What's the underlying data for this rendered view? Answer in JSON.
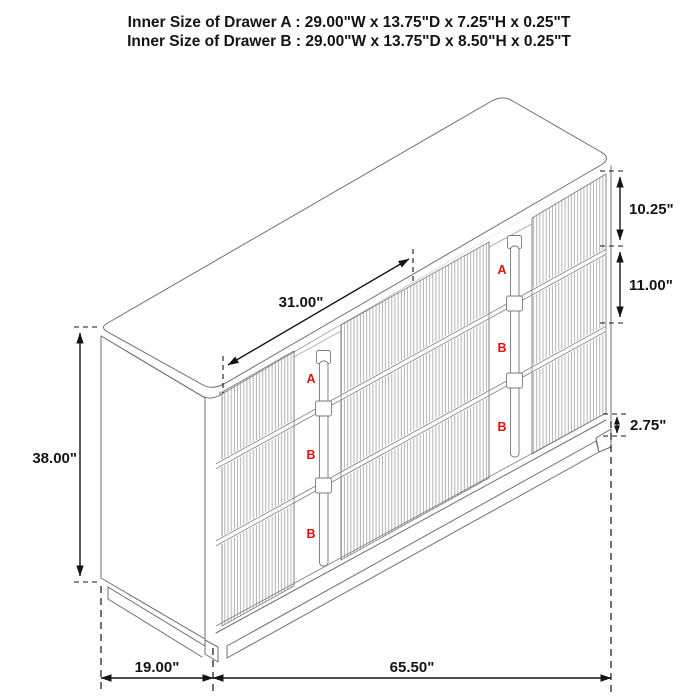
{
  "title": {
    "line1": "Inner Size of Drawer A : 29.00\"W x 13.75\"D x 7.25\"H x 0.25\"T",
    "line2": "Inner Size of Drawer B : 29.00\"W x 13.75\"D x 8.50\"H x 0.25\"T"
  },
  "dimensions": {
    "top_span": "31.00\"",
    "drawer_a_height": "10.25\"",
    "drawer_b_height": "11.00\"",
    "base_height": "2.75\"",
    "overall_height": "38.00\"",
    "overall_depth": "19.00\"",
    "overall_width": "65.50\""
  },
  "drawer_labels": {
    "left_handle": [
      "A",
      "B",
      "B"
    ],
    "right_handle": [
      "A",
      "B",
      "B"
    ]
  },
  "colors": {
    "label_red": "#e01010",
    "outline_gray": "#6f6f6f",
    "flute_gray": "#9a9a9a",
    "dimension_black": "#141414",
    "background": "#ffffff"
  }
}
